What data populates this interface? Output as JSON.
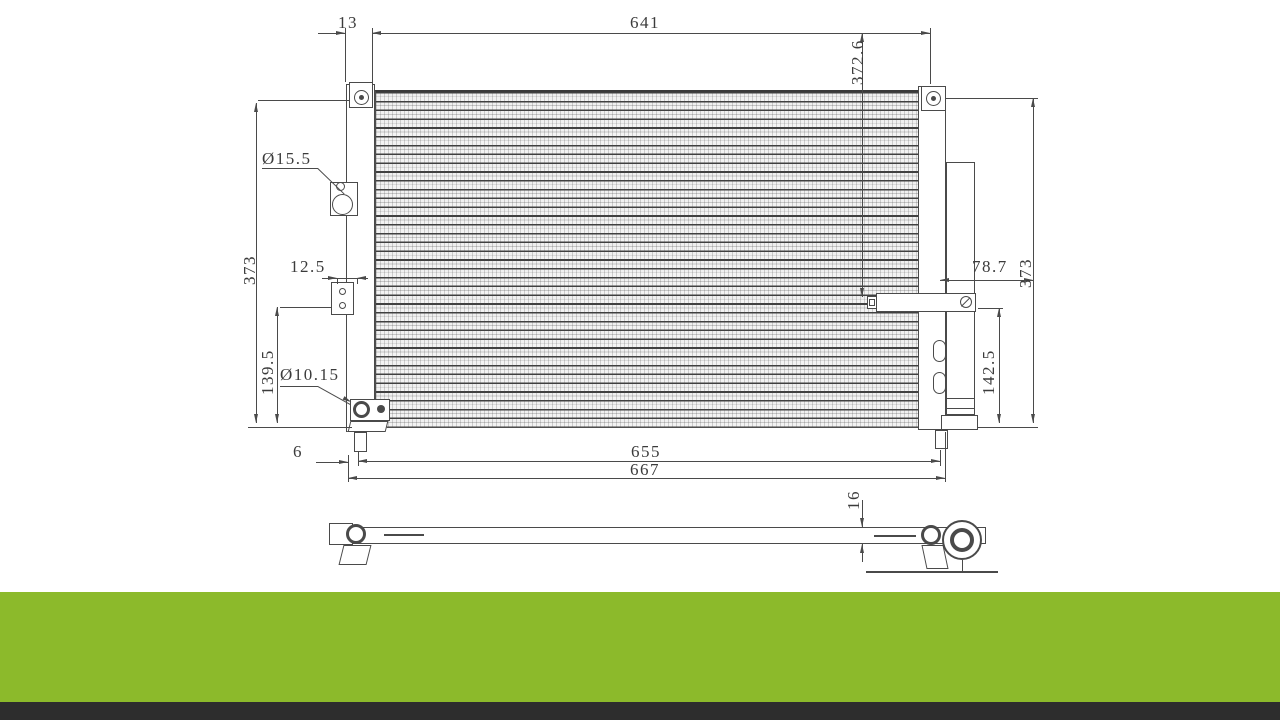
{
  "drawing": {
    "description": "AC condenser engineering drawing, front view and side profile view",
    "dims": {
      "header_width": "13",
      "core_width": "641",
      "inner_height": "372.6",
      "left_overall_height": "373",
      "upper_port_diameter": "Ø15.5",
      "inlet_bracket_width": "12.5",
      "lower_left_span": "139.5",
      "lower_port_diameter": "Ø10.15",
      "pipe_stub_length": "78.7",
      "right_overall_height": "373",
      "pipe_to_base": "142.5",
      "mounting_span": "655",
      "overall_width": "667",
      "pin_offset": "6",
      "profile_thickness": "16"
    },
    "colors": {
      "line": "#4a4a4a",
      "accent_band": "#8cba2b",
      "footer_band": "#2d2d2d"
    }
  }
}
